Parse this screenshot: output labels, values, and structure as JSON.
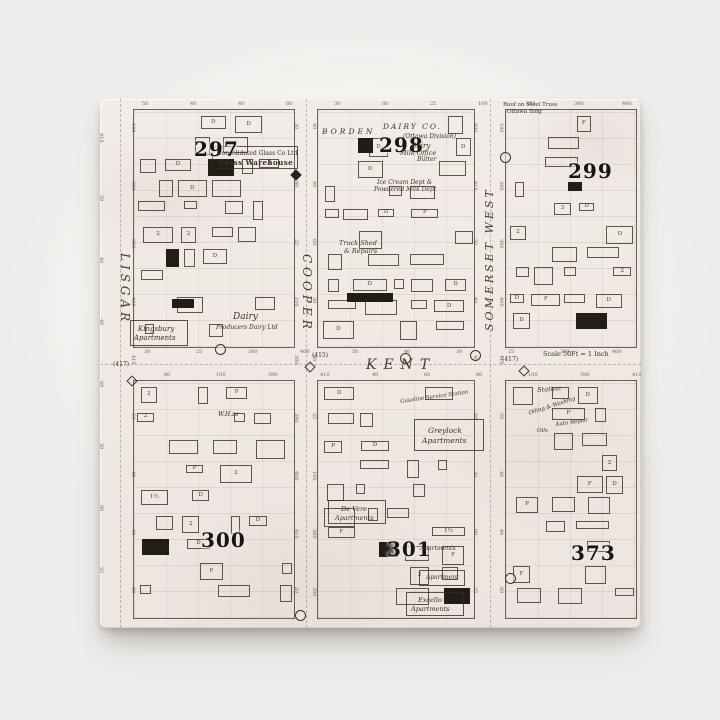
{
  "photo": {
    "background_color": "#f4f3f0",
    "tile_color": "#efe8e3",
    "line_color": "#3a3127"
  },
  "map": {
    "plates": [
      {
        "label": "297",
        "x": 94,
        "y": 40
      },
      {
        "label": "298",
        "x": 279,
        "y": 36
      },
      {
        "label": "299",
        "x": 468,
        "y": 62
      },
      {
        "label": "300",
        "x": 101,
        "y": 431
      },
      {
        "label": "301",
        "x": 287,
        "y": 440
      },
      {
        "label": "373",
        "x": 471,
        "y": 444
      }
    ],
    "streets": [
      {
        "name": "LISGAR",
        "orientation": "vertical",
        "reading": "down",
        "x": 31,
        "y": 154,
        "size": 12,
        "spacing": 4
      },
      {
        "name": "COOPER",
        "orientation": "vertical",
        "reading": "down",
        "x": 213,
        "y": 155,
        "size": 12,
        "spacing": 4
      },
      {
        "name": "SOMERSET  WEST",
        "orientation": "vertical",
        "reading": "up",
        "x": 384,
        "y": 232,
        "size": 11,
        "spacing": 3
      },
      {
        "name": "KENT",
        "orientation": "horizontal",
        "reading": "right",
        "x": 266,
        "y": 259,
        "size": 14,
        "spacing": 7
      }
    ],
    "annotations": [
      {
        "text": "Consolidated Glass Co Ltd",
        "x": 117,
        "y": 52,
        "size": 6
      },
      {
        "text": "Glass Warehouse",
        "x": 119,
        "y": 60,
        "size": 7,
        "weight": "bold",
        "spacing": 0.5
      },
      {
        "text": "BORDEN",
        "x": 222,
        "y": 29,
        "size": 7.5,
        "italic": true,
        "spacing": 3
      },
      {
        "text": "DAIRY CO.",
        "x": 283,
        "y": 24,
        "size": 7.5,
        "italic": true,
        "spacing": 2
      },
      {
        "text": "(Ottawa Division)",
        "x": 303,
        "y": 35,
        "size": 6,
        "italic": true
      },
      {
        "text": "Dairy",
        "x": 311,
        "y": 43,
        "size": 7,
        "italic": true
      },
      {
        "text": "Milk Office",
        "x": 300,
        "y": 51,
        "size": 6.5,
        "italic": true
      },
      {
        "text": "Butter",
        "x": 317,
        "y": 58,
        "size": 6,
        "italic": true
      },
      {
        "text": "Ice Cream Dept &",
        "x": 277,
        "y": 81,
        "size": 6,
        "italic": true
      },
      {
        "text": "Powdered Milk Dept",
        "x": 274,
        "y": 88,
        "size": 6,
        "italic": true
      },
      {
        "text": "Roof on Steel Truss",
        "x": 403,
        "y": 3,
        "size": 5.5
      },
      {
        "text": "Ottawa Bldg",
        "x": 407,
        "y": 10,
        "size": 5.5
      },
      {
        "text": "Truck Shed",
        "x": 239,
        "y": 141,
        "size": 6.5,
        "italic": true
      },
      {
        "text": "& Repairs",
        "x": 244,
        "y": 149,
        "size": 6.5,
        "italic": true
      },
      {
        "text": "Kingsbury",
        "x": 38,
        "y": 226,
        "size": 7,
        "italic": true
      },
      {
        "text": "Apartments",
        "x": 34,
        "y": 235,
        "size": 7,
        "italic": true
      },
      {
        "text": "Dairy",
        "x": 133,
        "y": 213,
        "size": 9,
        "italic": true
      },
      {
        "text": "Producers Dairy Ltd",
        "x": 116,
        "y": 226,
        "size": 6,
        "italic": true
      },
      {
        "text": "W.H.se",
        "x": 118,
        "y": 313,
        "size": 6,
        "italic": true
      },
      {
        "text": "Gasoline Service Station",
        "x": 300,
        "y": 300,
        "size": 5.5,
        "italic": true,
        "rot": -8
      },
      {
        "text": "Greylock",
        "x": 328,
        "y": 328,
        "size": 7.5,
        "italic": true
      },
      {
        "text": "Apartments",
        "x": 322,
        "y": 338,
        "size": 7.5,
        "italic": true
      },
      {
        "text": "De Vere",
        "x": 241,
        "y": 407,
        "size": 6.5,
        "italic": true
      },
      {
        "text": "Apartments",
        "x": 235,
        "y": 416,
        "size": 6.5,
        "italic": true
      },
      {
        "text": "Apartments",
        "x": 320,
        "y": 447,
        "size": 6,
        "italic": true
      },
      {
        "text": "Apartment",
        "x": 326,
        "y": 476,
        "size": 6,
        "italic": true
      },
      {
        "text": "Excello",
        "x": 318,
        "y": 498,
        "size": 6.5,
        "italic": true
      },
      {
        "text": "Apartments",
        "x": 311,
        "y": 507,
        "size": 6.5,
        "italic": true
      },
      {
        "text": "Scale 50Ft = 1 Inch",
        "x": 443,
        "y": 252,
        "size": 6.5
      },
      {
        "text": "Station",
        "x": 437,
        "y": 288,
        "size": 6.5,
        "italic": true,
        "rot": -4
      },
      {
        "text": "Oiling & Washing",
        "x": 428,
        "y": 312,
        "size": 5.5,
        "italic": true,
        "rot": -18
      },
      {
        "text": "Auto Repair",
        "x": 455,
        "y": 323,
        "size": 5.5,
        "italic": true,
        "rot": -8
      },
      {
        "text": "Oils",
        "x": 437,
        "y": 329,
        "size": 5.5,
        "italic": true
      }
    ],
    "outline_boxes": [
      [
        112,
        47,
        86,
        23
      ],
      [
        30,
        221,
        58,
        26
      ],
      [
        314,
        320,
        70,
        32
      ],
      [
        228,
        401,
        58,
        24
      ],
      [
        319,
        471,
        46,
        16
      ],
      [
        306,
        493,
        58,
        24
      ]
    ],
    "black_buildings": [
      [
        247,
        194,
        46,
        9
      ],
      [
        258,
        39,
        15,
        15
      ],
      [
        72,
        200,
        22,
        9
      ],
      [
        279,
        443,
        19,
        15
      ]
    ],
    "ring_markers": [
      [
        300,
        254
      ],
      [
        400,
        53
      ],
      [
        370,
        251
      ],
      [
        195,
        511
      ],
      [
        405,
        474
      ],
      [
        115,
        245
      ]
    ],
    "diamond_labels": [
      {
        "label": "(417)",
        "x": 13,
        "y": 262,
        "dx": 28,
        "dy": 278
      },
      {
        "label": "(415)",
        "x": 212,
        "y": 253,
        "dx": 206,
        "dy": 264
      },
      {
        "label": "(417)",
        "x": 402,
        "y": 257,
        "dx": 420,
        "dy": 268
      }
    ],
    "solid_diamonds": [
      [
        192,
        72
      ]
    ],
    "lot_numbers": [
      "50",
      "40",
      "40",
      "60",
      "30",
      "80",
      "25",
      "100",
      "380",
      "390",
      "400",
      "410"
    ],
    "building_symbols": [
      "D",
      "D",
      "2",
      "D",
      "1½",
      "3",
      "F",
      "D",
      "P",
      "2"
    ]
  }
}
